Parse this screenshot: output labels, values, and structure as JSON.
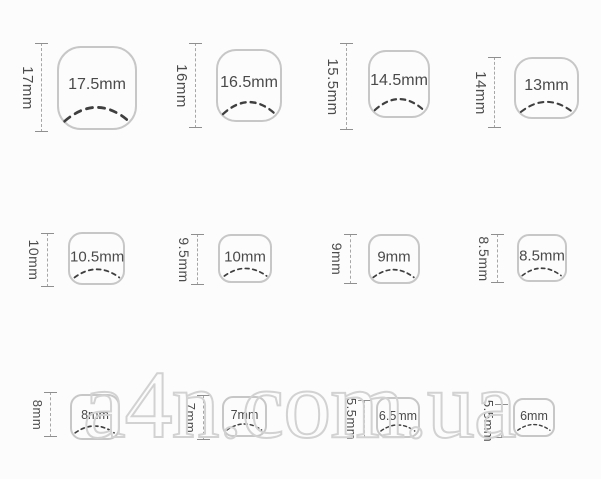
{
  "watermark": {
    "text": "a4n.com.ua",
    "color": "#d2d2d2"
  },
  "colors": {
    "background": "#fcfcfc",
    "nail_outline": "#c7c7c7",
    "smile_line": "#3f3f3f",
    "label_text": "#4a4a4a",
    "measure_line": "#a6a6a6",
    "watermark_outline": "#d2d2d2"
  },
  "nails": [
    {
      "height": "17mm",
      "width": "17.5mm"
    },
    {
      "height": "16mm",
      "width": "16.5mm"
    },
    {
      "height": "15.5mm",
      "width": "14.5mm"
    },
    {
      "height": "14mm",
      "width": "13mm"
    },
    {
      "height": "10mm",
      "width": "10.5mm"
    },
    {
      "height": "9.5mm",
      "width": "10mm"
    },
    {
      "height": "9mm",
      "width": "9mm"
    },
    {
      "height": "8.5mm",
      "width": "8.5mm"
    },
    {
      "height": "8mm",
      "width": "8mm"
    },
    {
      "height": "7mm",
      "width": "7mm"
    },
    {
      "height": "5.5mm",
      "width": "6.5mm"
    },
    {
      "height": "5.5mm",
      "width": "6mm"
    }
  ]
}
